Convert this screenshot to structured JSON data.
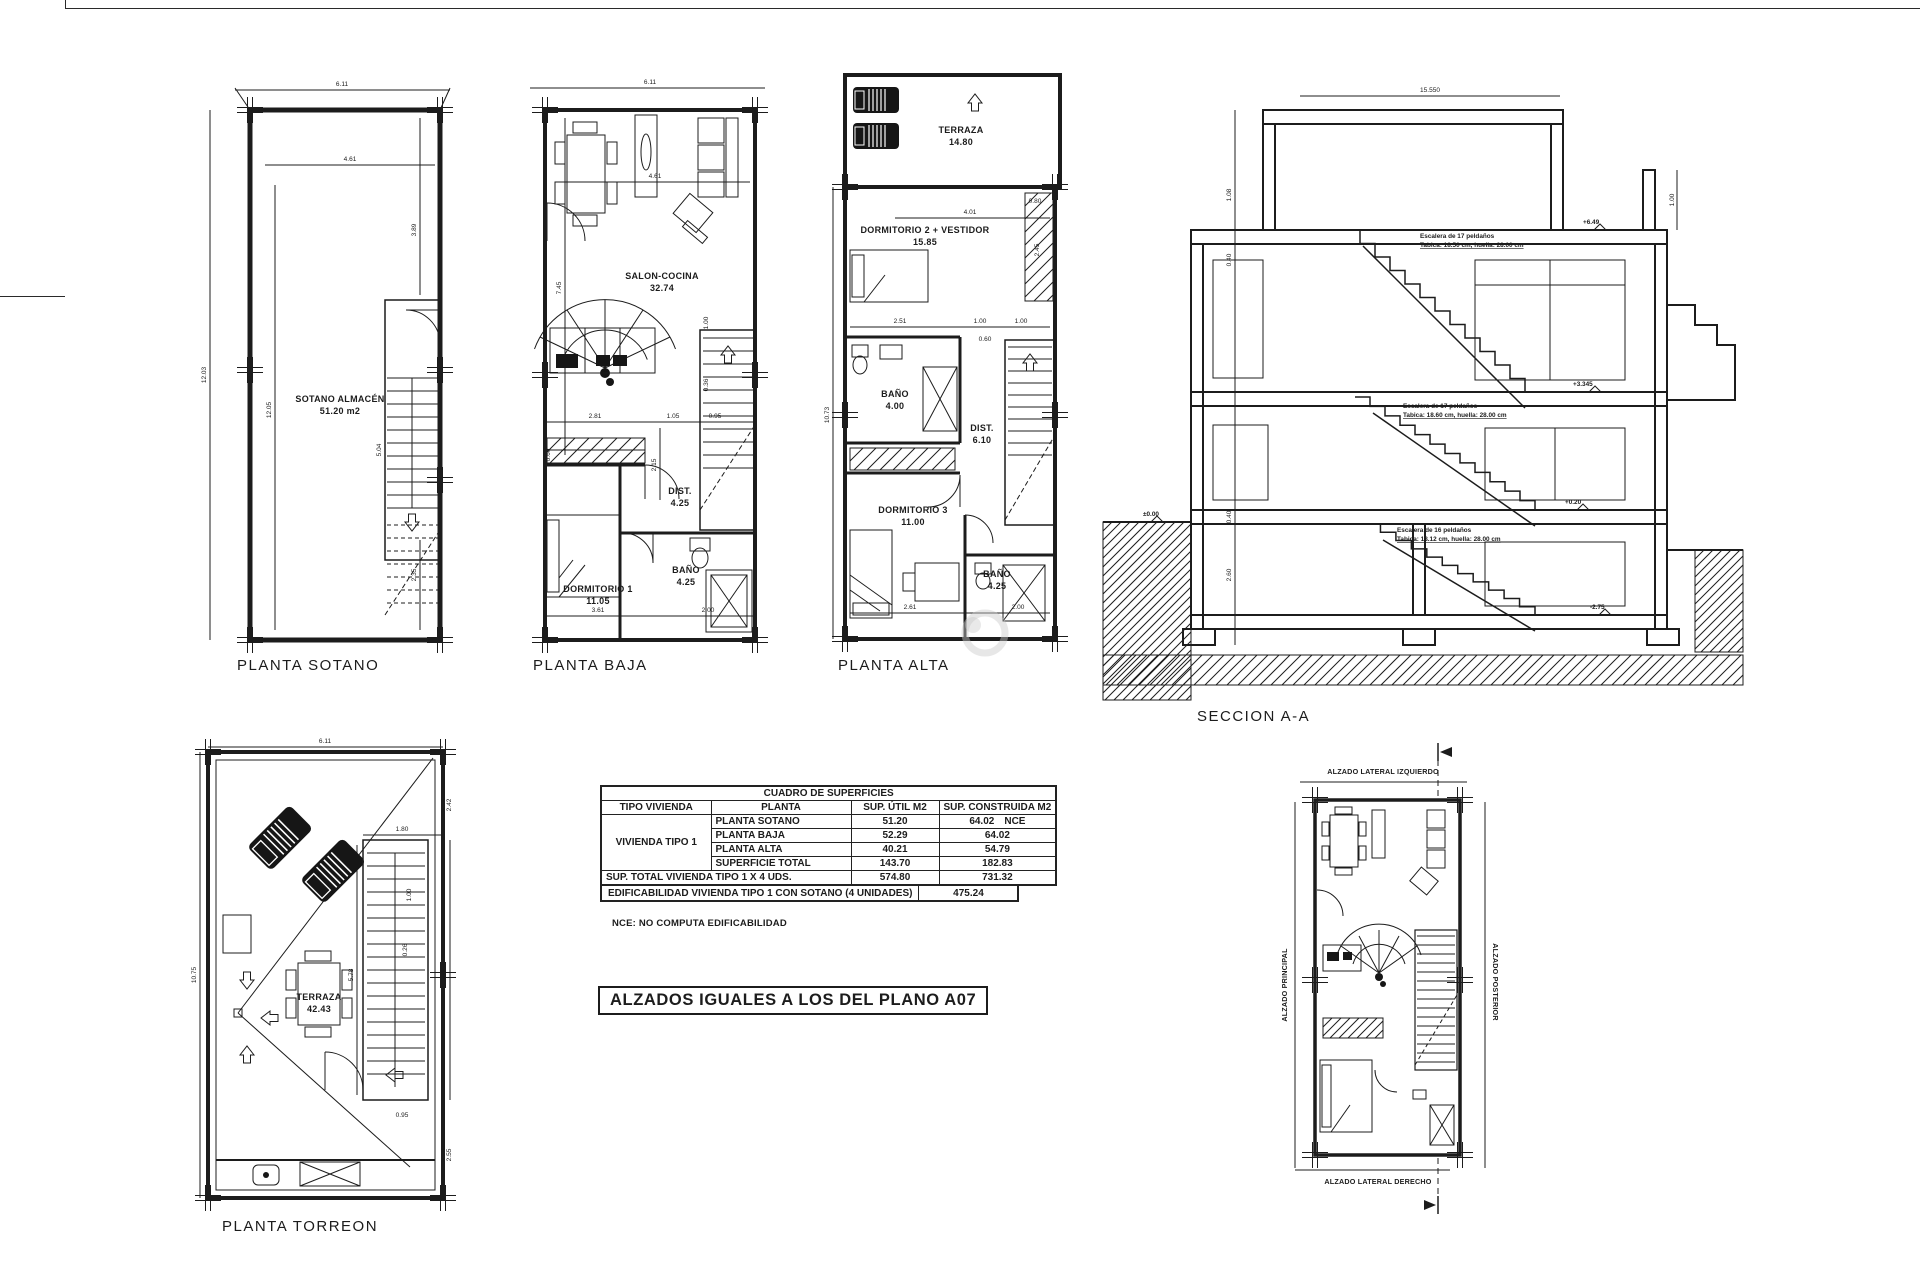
{
  "colors": {
    "ink": "#1c1c1c",
    "paper": "#ffffff",
    "watermark": "#c9c9c9"
  },
  "titles": {
    "sotano": "PLANTA SOTANO",
    "baja": "PLANTA BAJA",
    "alta": "PLANTA ALTA",
    "seccion": "SECCION A-A",
    "torreon": "PLANTA TORREON"
  },
  "rooms": {
    "sotano": {
      "name": "SOTANO ALMACÉN",
      "area": "51.20 m2"
    },
    "baja": {
      "salon": {
        "name": "SALON-COCINA",
        "area": "32.74"
      },
      "dorm1": {
        "name": "DORMITORIO 1",
        "area": "11.05"
      },
      "dist": {
        "name": "DIST.",
        "area": "4.25"
      },
      "bano": {
        "name": "BAÑO",
        "area": "4.25"
      }
    },
    "alta": {
      "terraza": {
        "name": "TERRAZA",
        "area": "14.80"
      },
      "dorm2": {
        "name": "DORMITORIO 2 + VESTIDOR",
        "area": "15.85"
      },
      "bano1": {
        "name": "BAÑO",
        "area": "4.00"
      },
      "dist": {
        "name": "DIST.",
        "area": "6.10"
      },
      "dorm3": {
        "name": "DORMITORIO 3",
        "area": "11.00"
      },
      "bano2": {
        "name": "BAÑO",
        "area": "4.25"
      }
    },
    "torreon": {
      "name": "TERRAZA",
      "area": "42.43"
    }
  },
  "dims": {
    "sotano": {
      "top": "6.11",
      "top_inner": "4.61",
      "left": "12.03",
      "left_inner": "12.05",
      "right_top": "3.89",
      "stair": "5.04",
      "right_bottom": "2.35"
    },
    "baja": {
      "top": "6.11",
      "top_inner": "4.61",
      "left_inner": "7.45",
      "wardrobe": "0.60",
      "w1": "2.81",
      "w2": "1.05",
      "w3": "0.95",
      "h1": "2.15",
      "s1": "1.00",
      "s2": "0.36",
      "b1": "3.61",
      "b2": "2.00"
    },
    "alta": {
      "left": "10.73",
      "top": "4.01",
      "m1": "2.51",
      "m2": "1.00",
      "m3": "1.00",
      "r1": "0.80",
      "r2": "2.45",
      "r3": "0.60",
      "b1": "2.61",
      "b2": "2.00"
    },
    "torreon": {
      "top": "6.11",
      "left": "10.75",
      "r1": "2.42",
      "r2": "1.80",
      "r3": "1.00",
      "r4": "0.26",
      "r5": "5.08",
      "r6": "0.95",
      "r7": "5.78",
      "r8": "2.55"
    },
    "seccion": {
      "top": "15.550",
      "d1": "1.08",
      "d2": "0.40",
      "d3": "0.40",
      "d4": "2.60",
      "d5": "1.00"
    }
  },
  "seccion": {
    "stair_notes": [
      {
        "l1": "Escalera de 17 peldaños",
        "l2": "Tabica: 18.50 cm, huella: 28.00 cm"
      },
      {
        "l1": "Escalera de 17 peldaños",
        "l2": "Tabica: 18.60 cm, huella: 28.00 cm"
      },
      {
        "l1": "Escalera de 16 peldaños",
        "l2": "Tabica: 18.12 cm, huella: 28.00 cm"
      }
    ],
    "levels": {
      "l0": "±0.00",
      "l1": "+0.20",
      "l2": "+3.345",
      "l3": "+6.49",
      "lb": "-2.75"
    }
  },
  "table": {
    "title": "CUADRO DE SUPERFICIES",
    "headers": [
      "TIPO VIVIENDA",
      "PLANTA",
      "SUP. ÚTIL M2",
      "SUP. CONSTRUIDA M2"
    ],
    "tipo": "VIVIENDA TIPO 1",
    "rows": [
      {
        "planta": "PLANTA SOTANO",
        "util": "51.20",
        "construida": "64.02",
        "nota": "NCE"
      },
      {
        "planta": "PLANTA BAJA",
        "util": "52.29",
        "construida": "64.02",
        "nota": ""
      },
      {
        "planta": "PLANTA ALTA",
        "util": "40.21",
        "construida": "54.79",
        "nota": ""
      },
      {
        "planta": "SUPERFICIE TOTAL",
        "util": "143.70",
        "construida": "182.83",
        "nota": ""
      }
    ],
    "total_row": {
      "label": "SUP. TOTAL VIVIENDA TIPO 1 X 4 UDS.",
      "util": "574.80",
      "construida": "731.32"
    },
    "edificabilidad": {
      "label": "EDIFICABILIDAD VIVIENDA TIPO 1 CON SOTANO (4 UNIDADES)",
      "value": "475.24"
    }
  },
  "nce_note": "NCE:  NO COMPUTA EDIFICABILIDAD",
  "note_box": "ALZADOS IGUALES A LOS DEL PLANO A07",
  "keyplan": {
    "top": "ALZADO LATERAL IZQUIERDO",
    "left": "ALZADO PRINCIPAL",
    "right": "ALZADO POSTERIOR",
    "bottom": "ALZADO LATERAL DERECHO"
  }
}
